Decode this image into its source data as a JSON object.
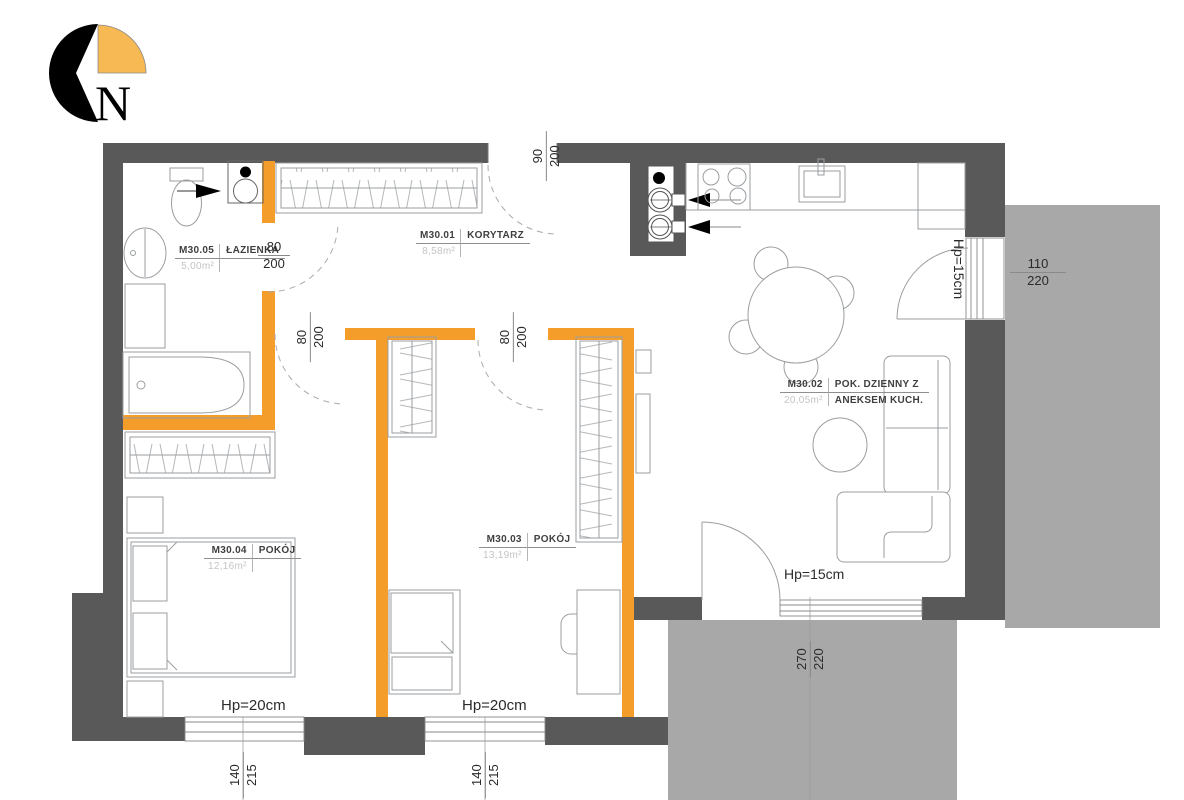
{
  "compass": {
    "label": "N"
  },
  "rooms": {
    "bathroom": {
      "id": "M30.05",
      "area": "5,00m²",
      "name": "ŁAZIENKA"
    },
    "corridor": {
      "id": "M30.01",
      "area": "8,58m²",
      "name": "KORYTARZ"
    },
    "living": {
      "id": "M30.02",
      "area": "20,05m²",
      "name": "POK. DZIENNY Z",
      "name2": "ANEKSEM KUCH."
    },
    "room3": {
      "id": "M30.03",
      "area": "13,19m²",
      "name": "POKÓJ"
    },
    "room4": {
      "id": "M30.04",
      "area": "12,16m²",
      "name": "POKÓJ"
    }
  },
  "dims": {
    "entrance": {
      "w": "90",
      "h": "200"
    },
    "bathroom_door": {
      "w": "80",
      "h": "200"
    },
    "room4_door": {
      "w": "80",
      "h": "200"
    },
    "room3_door": {
      "w": "80",
      "h": "200"
    },
    "balcony_east": {
      "w": "110",
      "h": "220"
    },
    "balcony_south": {
      "w": "270",
      "h": "220"
    },
    "window_left": {
      "w": "140",
      "h": "215"
    },
    "window_right": {
      "w": "140",
      "h": "215"
    }
  },
  "parapets": {
    "east": "Hp=15cm",
    "south": "Hp=15cm",
    "room4": "Hp=20cm",
    "room3": "Hp=20cm"
  },
  "colors": {
    "wall": "#595959",
    "balcony": "#a8a8a8",
    "highlight_wall": "#F49D2A",
    "compass_orange": "#F7B954",
    "furniture_line": "#9a9ea1"
  }
}
